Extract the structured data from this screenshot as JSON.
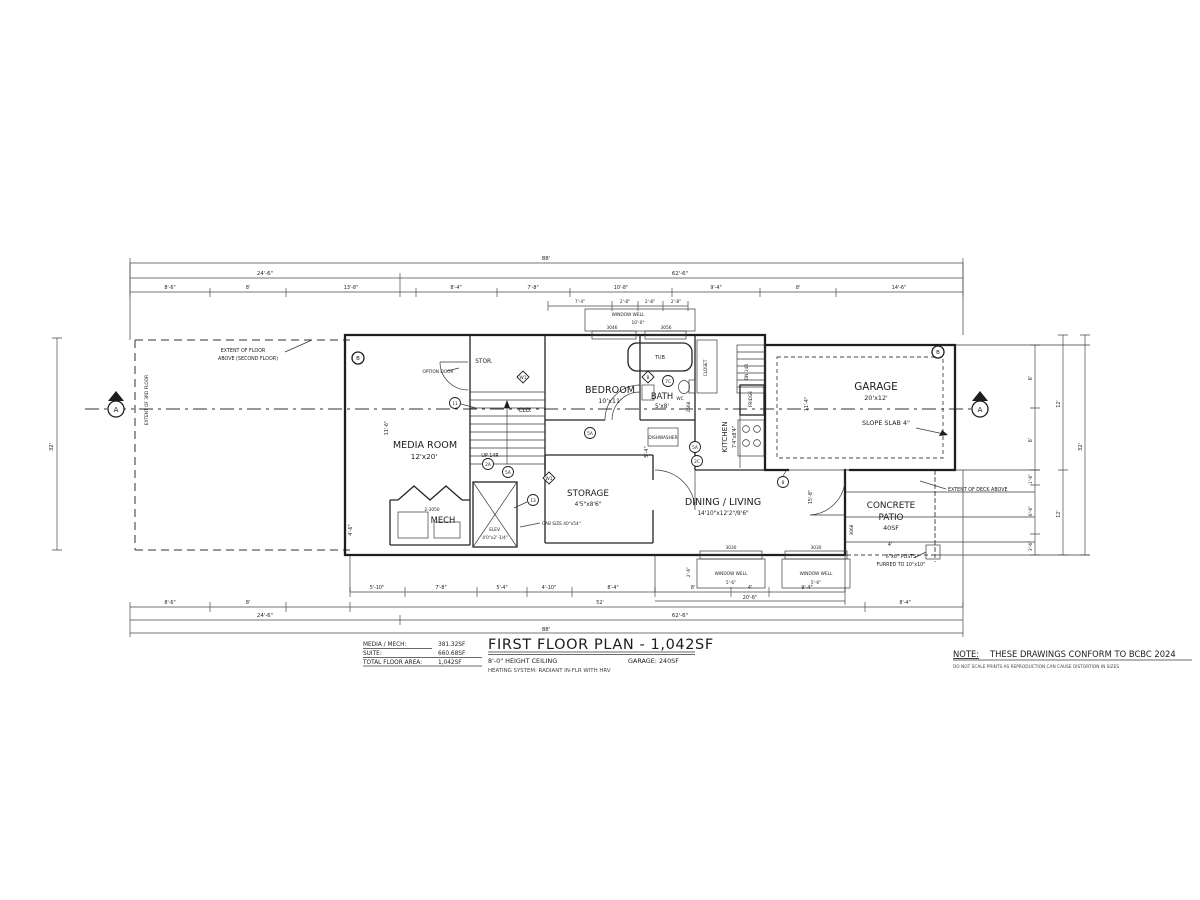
{
  "drawing": {
    "title": "FIRST FLOOR PLAN - 1,042SF",
    "subtitle_left": "8'-0\" HEIGHT CEILING",
    "subtitle_right": "GARAGE: 240SF",
    "subtitle_bottom": "HEATING SYSTEM: RADIANT IN-FLR WITH HRV",
    "note_title": "NOTE:",
    "note_text": "THESE DRAWINGS CONFORM TO BCBC 2024",
    "note_sub": "DO NOT SCALE PRINTS AS REPRODUCTION CAN CAUSE DISTORTION IN SIZES",
    "area_table": {
      "row1_label": "MEDIA / MECH:",
      "row1_value": "381.32SF",
      "row2_label": "SUITE:",
      "row2_value": "660.68SF",
      "row3_label": "TOTAL FLOOR AREA:",
      "row3_value": "1,042SF"
    }
  },
  "rooms": {
    "media": {
      "name": "MEDIA ROOM",
      "size": "12'x20'"
    },
    "bedroom": {
      "name": "BEDROOM",
      "size": "10'x11'"
    },
    "bath": {
      "name": "BATH",
      "size": "5'x8'"
    },
    "kitchen": {
      "name": "KITCHEN",
      "size": "7'4\"x8'4\""
    },
    "dining": {
      "name": "DINING / LIVING",
      "size": "14'10\"x12'2\"/9'6\""
    },
    "garage": {
      "name": "GARAGE",
      "size": "20'x12'"
    },
    "storage": {
      "name": "STORAGE",
      "size": "4'5\"x8'6\""
    },
    "mech": {
      "name": "MECH",
      "window": "2-3050"
    },
    "stor": {
      "name": "STOR."
    },
    "clo": {
      "name": "CLO."
    },
    "patio": {
      "name_1": "CONCRETE",
      "name_2": "PATIO",
      "size": "40SF"
    }
  },
  "labels": {
    "tub": "TUB",
    "wc": "WC",
    "fridge": "FRIDGE",
    "closet": "CLOSET",
    "up": "UP 14R",
    "dn": "DN 14R",
    "option_door": "OPTION DOOR",
    "dishwasher": "DISHWASHER",
    "slope": "SLOPE SLAB 4\"",
    "elev_1": "ELEV.",
    "elev_2": "4'0\"x2'-1/4\"",
    "elev_cab": "CAB SIZE 40\"x54\"",
    "extent_second_1": "EXTENT OF FLOOR",
    "extent_second_2": "ABOVE (SECOND FLOOR)",
    "extent_third": "EXTENT OF 3RD FLOOR",
    "extent_deck": "EXTENT OF DECK ABOVE",
    "posts_1": "6\"x6\" POSTS",
    "posts_2": "FURRED TO 10\"x10\"",
    "window_well": "WINDOW WELL",
    "win_3046": "3046",
    "win_3056": "3056",
    "win_3030": "3030",
    "well_width": "5'-6\"",
    "well_depth": "2'-6\"",
    "well_dim": "10'-0\"",
    "d2668": "2668",
    "d3068": "3068",
    "tag_b": "B"
  },
  "markers": {
    "section_a": "A",
    "section_b": "B",
    "k8": "8",
    "k11": "11",
    "k13": "13",
    "k2a": "2A",
    "k2c": "2C",
    "k5a": "5A",
    "k7c": "7C",
    "w1": "W1"
  },
  "dims": {
    "top_total": "88'",
    "top_l": "24'-6\"",
    "top_r": "62'-6\"",
    "top3": [
      "8'-6\"",
      "8'",
      "13'-8\"",
      "8'-4\"",
      "7'-8\"",
      "10'-8\"",
      "9'-4\"",
      "8'",
      "14'-6\""
    ],
    "top4": [
      "7'-4\"",
      "2'-8\"",
      "2'-8\"",
      "2'-8\""
    ],
    "left_total": "32'",
    "right_total": "32'",
    "right_segs": [
      "6'",
      "6'",
      "1'-6\"",
      "6'-6\"",
      "3'-6\""
    ],
    "right_12a": "12'",
    "right_12b": "12'",
    "bot1": [
      "5'-10\"",
      "7'-8\"",
      "5'-4\"",
      "4'-10\"",
      "8'-4\""
    ],
    "bot1r": [
      "8'",
      "4'",
      "9'-4\""
    ],
    "bot1r_total": "20'-6\"",
    "bot2": [
      "8'-6\"",
      "8'",
      "52'",
      "8'-4\""
    ],
    "bot_l": "24'-6\"",
    "bot_r": "62'-6\"",
    "bot_total": "88'",
    "patio_4": "4'",
    "interior": {
      "media_h": "11'-6\"",
      "garage_h": "11'-4\"",
      "d54": "5'-4\"",
      "d158": "15'-8\"",
      "d46": "4'-6\""
    }
  }
}
